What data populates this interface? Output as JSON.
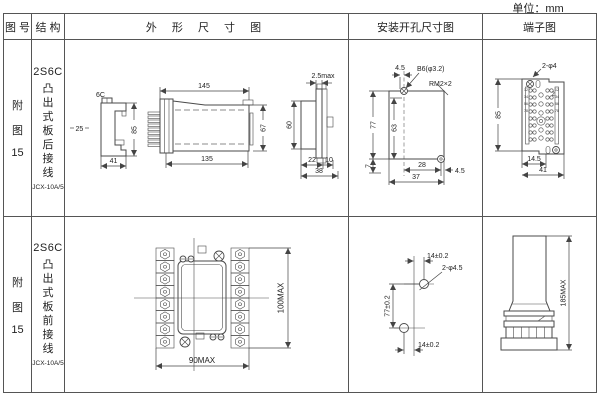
{
  "unit_label": "单位：mm",
  "colors": {
    "line": "#4a4a4a",
    "text": "#222222",
    "border": "#555555",
    "background": "#ffffff"
  },
  "header": {
    "fig_no": "图 号",
    "structure": "结 构",
    "outline": "外 形 尺 寸 图",
    "mounting": "安装开孔尺寸图",
    "terminal": "端子图"
  },
  "rows": [
    {
      "fig_no": {
        "char1": "附",
        "char2": "图",
        "num": "15"
      },
      "structure": {
        "model": "2S6C",
        "desc": "凸出式板后接线",
        "type": "JCX-10A/5"
      },
      "outline": {
        "view_label": "6C",
        "dim_25": "25",
        "dim_85": "85",
        "dim_41": "41",
        "dim_145": "145",
        "dim_135": "135",
        "dim_67": "67",
        "dim_25max": "2.5max",
        "dim_60": "60",
        "dim_22": "22",
        "dim_10": "10",
        "dim_38": "38"
      },
      "mounting": {
        "dim_45_top": "4.5",
        "hole_label": "B6(φ3.2)",
        "thread_label": "RM2×2",
        "dim_77": "77",
        "dim_63": "63",
        "dim_7": "7",
        "dim_28": "28",
        "dim_37": "37",
        "dim_45_right": "4.5"
      },
      "terminal": {
        "hole_label": "2-φ4",
        "num_label": "2",
        "dim_85": "85",
        "dim_145": "14.5",
        "dim_41": "41",
        "numbers": "12345678"
      }
    },
    {
      "fig_no": {
        "char1": "附",
        "char2": "图",
        "num": "15"
      },
      "structure": {
        "model": "2S6C",
        "desc": "凸出式板前接线",
        "type": "JCX-10A/5"
      },
      "outline": {
        "dim_height": "100MAX",
        "dim_width": "90MAX"
      },
      "mounting": {
        "dim_top": "14±0.2",
        "hole_label": "2-φ4.5",
        "dim_vert": "77±0.2",
        "dim_bottom": "14±0.2"
      },
      "terminal": {
        "dim_height": "185MAX"
      }
    }
  ]
}
